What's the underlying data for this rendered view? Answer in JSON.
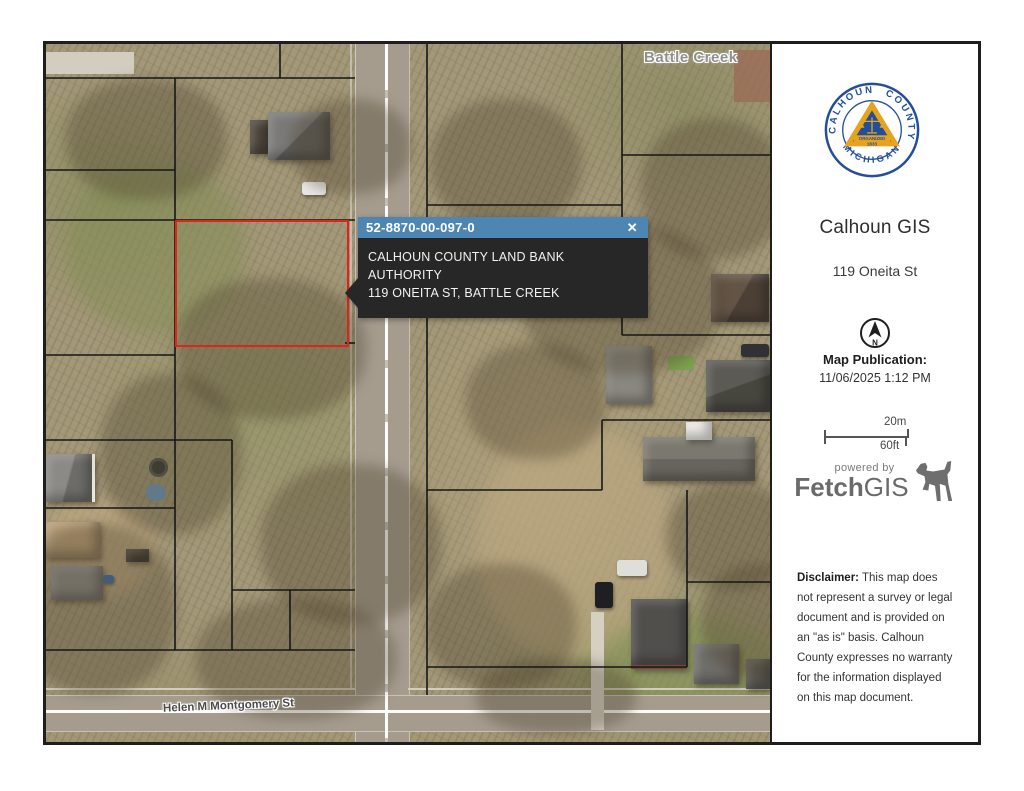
{
  "map": {
    "city_label": "Battle Creek",
    "street_label": "Helen M Montgomery St",
    "selected_parcel_color": "#e0241b",
    "popup": {
      "parcel_id": "52-8870-00-097-0",
      "close_glyph": "✕",
      "owner": "CALHOUN COUNTY LAND BANK AUTHORITY",
      "address": "119 ONEITA ST, BATTLE CREEK",
      "header_bg": "#4e86b3",
      "body_bg": "#272727"
    }
  },
  "sidebar": {
    "seal": {
      "arc_left": "CALHOUN",
      "arc_right": "COUNTY",
      "arc_bottom": "MICHIGAN",
      "banner_line1": "ORGANIZED",
      "banner_line2": "1833",
      "ring_color": "#234f9a",
      "gold_color": "#e6a41e"
    },
    "title": "Calhoun GIS",
    "subtitle": "119 Oneita St",
    "north_letter": "N",
    "publication_label": "Map Publication:",
    "publication_datetime": "11/06/2025 1:12 PM",
    "scale_bar": {
      "metric_label": "20m",
      "imperial_label": "60ft"
    },
    "brand": {
      "powered_by": "powered by",
      "name_bold": "Fetch",
      "name_light": "GIS"
    },
    "disclaimer": {
      "label": "Disclaimer:",
      "text": "This map does not represent a survey or legal document and is provided on an \"as is\" basis. Calhoun County expresses no warranty for the information displayed on this map document."
    }
  }
}
